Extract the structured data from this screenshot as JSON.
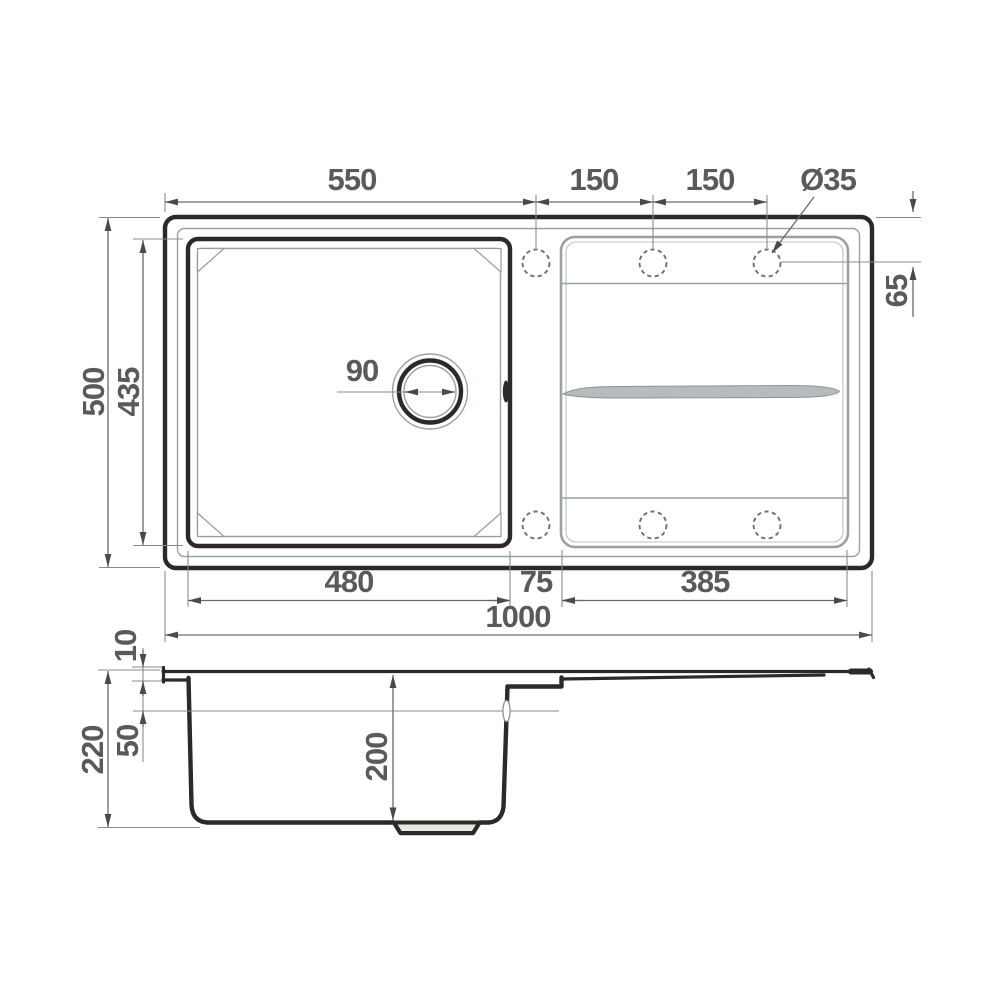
{
  "colors": {
    "outline": "#2d2926",
    "detail_gray": "#9aa2a4",
    "dimension_text": "#5a5a5a",
    "dimension_lines": "#8b8b8b",
    "arrow": "#4a4a4a",
    "background": "#ffffff"
  },
  "top_view": {
    "overall_width_top": "550",
    "tap_spacing_1": "150",
    "tap_spacing_2": "150",
    "tap_hole_diameter": "Ø35",
    "tap_hole_offset": "65",
    "overall_depth": "500",
    "bowl_outer_depth": "435",
    "drain_diameter": "90",
    "bowl_width": "480",
    "middle_strip_width": "75",
    "drainboard_width": "385",
    "overall_width": "1000"
  },
  "side_view": {
    "rim_height": "10",
    "overall_height": "220",
    "overflow_level": "50",
    "bowl_depth": "200"
  }
}
